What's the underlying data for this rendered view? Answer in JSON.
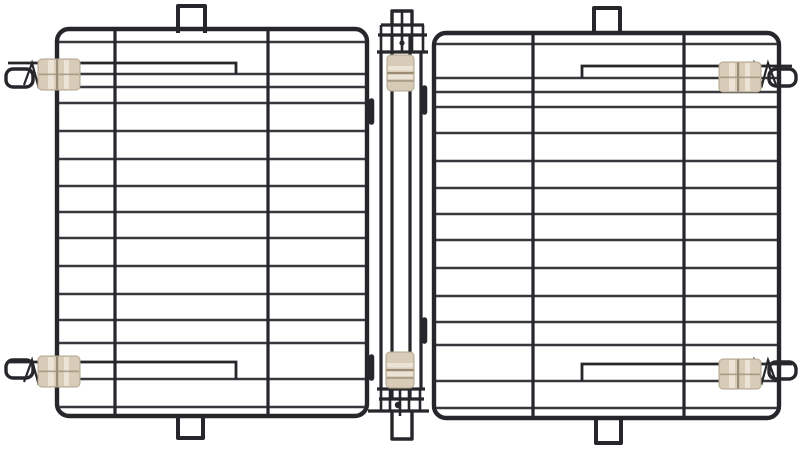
{
  "meta": {
    "title": "Two black wire crate panels joined by a center hinge strip, with tan plastic latch clips",
    "scene": "product photo on white background"
  },
  "colors": {
    "background": "#ffffff",
    "wire": "#26262b",
    "wire_thin": "#38383f",
    "clip_base": "#d8ccb8",
    "clip_highlight": "#ebe4d6",
    "clip_groove": "#9b8d75",
    "clip_edge": "#b2a58d"
  },
  "structure": {
    "left_panel": {
      "wire_x1": 59,
      "wire_x2": 365,
      "h_wires_y": [
        42,
        74,
        87,
        103,
        131,
        159,
        186,
        212,
        238,
        266,
        294,
        320,
        343,
        379,
        407
      ],
      "v_wires_x": [
        115,
        268
      ],
      "v_y1": 31,
      "v_y2": 414
    },
    "right_panel": {
      "wire_x1": 436,
      "wire_x2": 777,
      "h_wires_y": [
        44,
        78,
        92,
        107,
        133,
        161,
        188,
        214,
        240,
        268,
        296,
        322,
        345,
        381,
        408
      ],
      "v_wires_x": [
        533,
        684
      ],
      "v_y1": 35,
      "v_y2": 416
    }
  },
  "inventory": {
    "wire_panels": 2,
    "hinge_strips": 1,
    "latch_clips": 6,
    "hanger_tabs": 6,
    "latch_loops": 4,
    "spring_zigzags": 4
  }
}
